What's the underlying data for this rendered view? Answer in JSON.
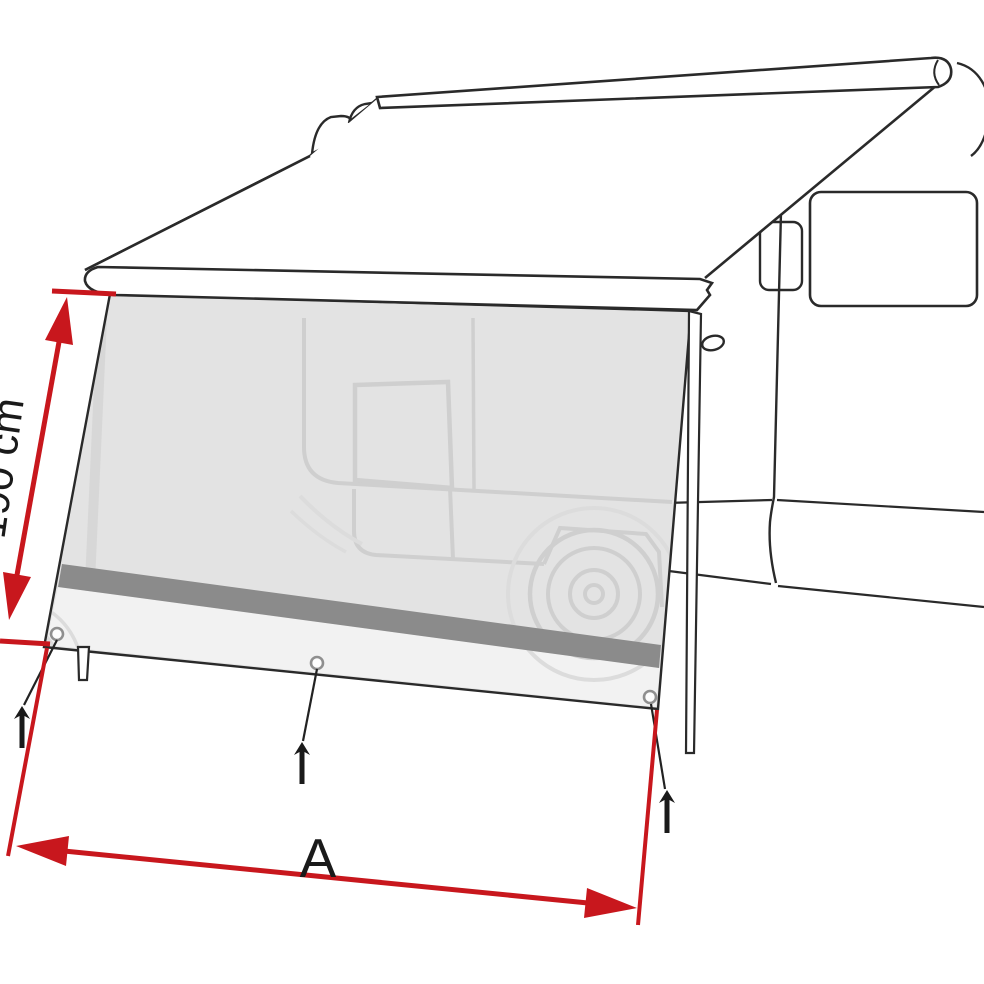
{
  "page": {
    "background": "#ffffff"
  },
  "diagram": {
    "subject": "camper-van awning side sun-view panel, technical line illustration",
    "dimension_labels": {
      "height": "190 cm",
      "width": "A"
    },
    "colors": {
      "background": "#ffffff",
      "red": "#c8171d",
      "outline": "#2a2a2a",
      "panel": "#e3e3e3",
      "band": "#8b8b8b",
      "strip": "#f2f2f2",
      "ghost": "#cfcfcf",
      "ghost_soft": "#dcdcdc",
      "ghost_leg": "#d7d7d7"
    }
  }
}
